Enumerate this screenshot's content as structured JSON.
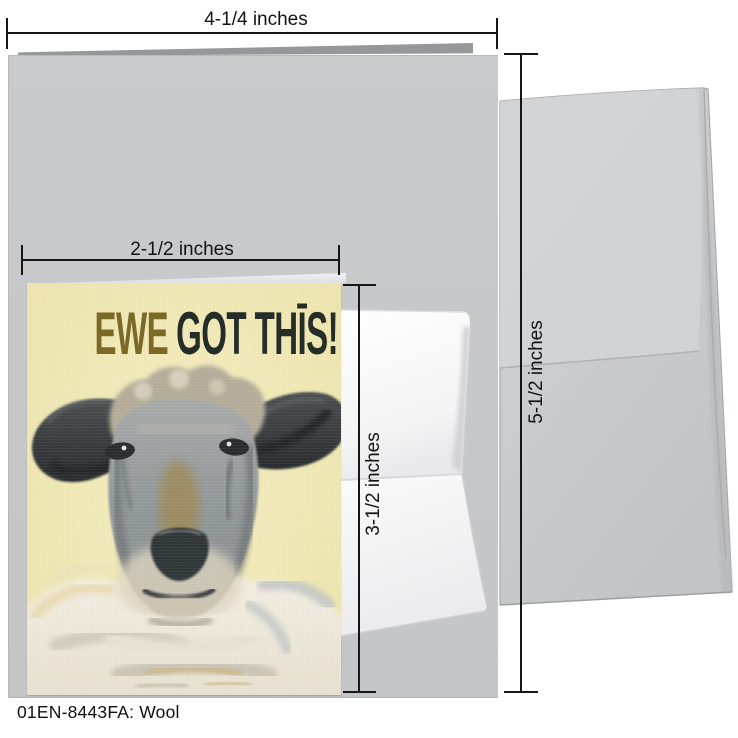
{
  "measurements": {
    "card_width": "4-1/4 inches",
    "notecard_width": "2-1/2 inches",
    "notecard_height": "3-1/2 inches",
    "card_height": "5-1/2 inches"
  },
  "card_design": {
    "title_word1": "EWE",
    "title_rest": "GOT THĪS!",
    "title_word1_color": "#7a6a26",
    "title_rest_color": "#262d28",
    "background_color": "#f3ebb6",
    "artwork": "sheep-painting"
  },
  "caption": {
    "sku": "01EN-8443FA:",
    "name": "Wool"
  },
  "colors": {
    "card_gray": "#c7c8ca",
    "envelope_gray": "#cbcdcf",
    "dimension_line": "#161616"
  }
}
